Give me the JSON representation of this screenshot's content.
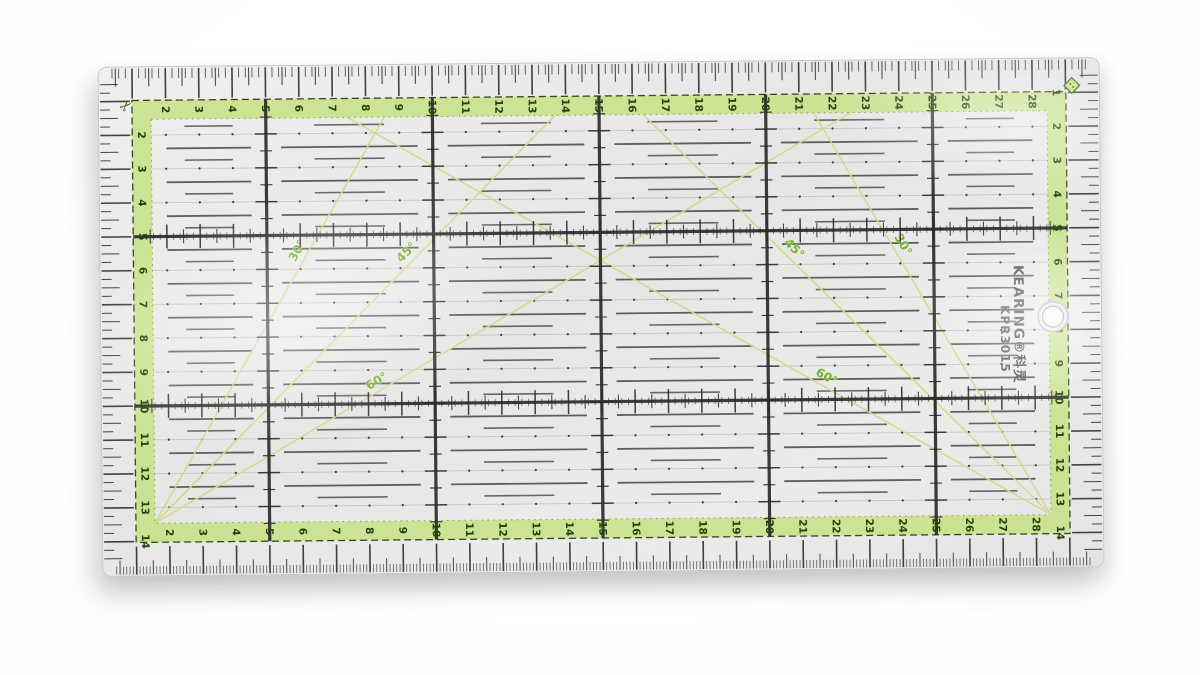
{
  "photo": {
    "subject": "transparent patchwork quilting ruler on white background"
  },
  "ruler": {
    "brand": "KEARING",
    "brand_registered": "®",
    "brand_chinese": "科灵",
    "model": "KPR3015",
    "width_cm": 30,
    "height_cm": 15,
    "major_grid_cm": 5,
    "scales": {
      "top_numbers": [
        2,
        3,
        4,
        5,
        6,
        7,
        8,
        9,
        10,
        11,
        12,
        13,
        14,
        15,
        16,
        17,
        18,
        19,
        20,
        21,
        22,
        23,
        24,
        25,
        26,
        27,
        28
      ],
      "bottom_numbers": [
        2,
        3,
        4,
        5,
        6,
        7,
        8,
        9,
        10,
        11,
        12,
        13,
        14,
        15,
        16,
        17,
        18,
        19,
        20,
        21,
        22,
        23,
        24,
        25,
        26,
        27,
        28
      ],
      "left_numbers": [
        2,
        3,
        4,
        5,
        6,
        7,
        8,
        9,
        10,
        11,
        12,
        13,
        14
      ],
      "right_numbers": [
        1,
        2,
        3,
        4,
        5,
        6,
        7,
        8,
        9,
        10,
        11,
        12,
        13,
        14
      ]
    },
    "angle_markings": {
      "left_group": [
        {
          "label": "30°",
          "angle_from_vertical_deg": 30
        },
        {
          "label": "45°",
          "angle_from_vertical_deg": 45
        },
        {
          "label": "60°",
          "angle_from_vertical_deg": 60
        }
      ],
      "right_group": [
        {
          "label": "30°",
          "angle_from_vertical_deg": 30
        },
        {
          "label": "45°",
          "angle_from_vertical_deg": 45
        },
        {
          "label": "60°",
          "angle_from_vertical_deg": 60
        }
      ]
    },
    "corner_icons": {
      "top_left": "scissors-icon",
      "top_right": "diamond-button-icon"
    },
    "features": {
      "hanging_hole": true
    },
    "colors": {
      "band_green": "#c9e28c",
      "band_number_green": "#25400d",
      "angle_label_green": "#74b02a",
      "diagonal_green": "#d4da8e",
      "ink_black": "#2c2c2e",
      "dash_gray": "#47474a",
      "plastic_gray": "#e9e9e8",
      "background": "#ffffff"
    }
  }
}
